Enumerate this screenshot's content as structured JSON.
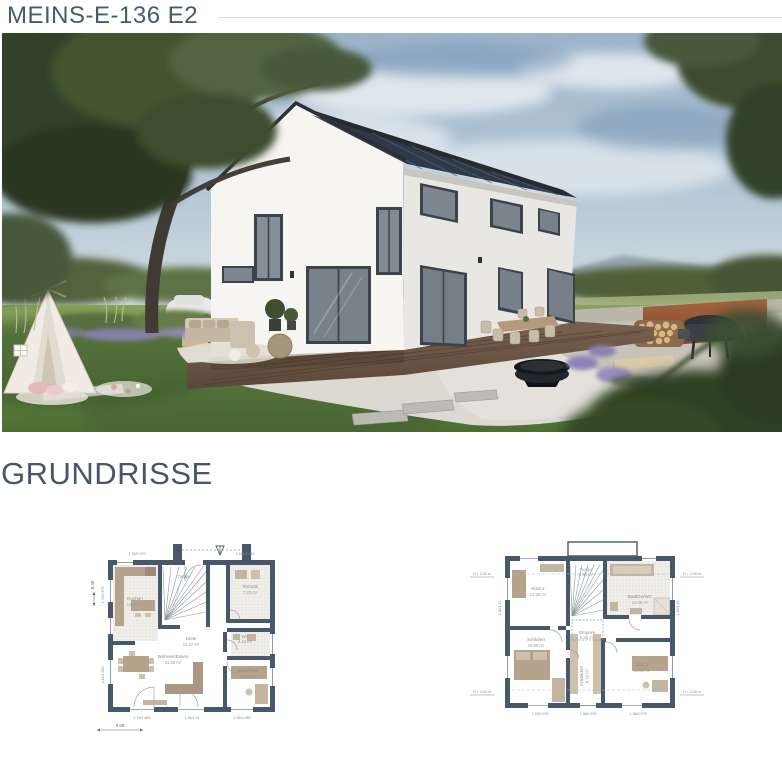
{
  "header": {
    "title": "MEINS-E-136 E2"
  },
  "section": {
    "heading": "GRUNDRISSE"
  },
  "colors": {
    "accent_text": "#46566b",
    "divider": "#dadada",
    "plan_wall": "#47586b",
    "plan_furniture": "#b7a28c",
    "corten_wall": "#9c5a34",
    "roof": "#262b31"
  },
  "floorplans": {
    "erdgeschoss": {
      "rooms": {
        "kochen": {
          "label": "Kochen",
          "area": "12.05 m²"
        },
        "treppe": {
          "label": "Treppe",
          "area": "5.98 m²"
        },
        "technik": {
          "label": "Technik",
          "area": "7.23 m²"
        },
        "diele": {
          "label": "Diele",
          "area": "12.27 m²"
        },
        "wc": {
          "label": "WC",
          "area": "3.34 m²"
        },
        "wohnen": {
          "label": "Wohnen/Essen",
          "area": "31.06 m²"
        },
        "buero": {
          "label": "Büro/Gast",
          "area": "10.35 m²"
        }
      },
      "dimensions": {
        "width": "9.58",
        "height": "8.48",
        "top_left": "1.76/0.975",
        "top_right": "1.185/2.415",
        "bottom_left": "1.76/1.885",
        "bottom_mid": "1.36/1.01",
        "bottom_right": "1.36/1.085",
        "left_top": "1.76/0.975",
        "left_bottom": "2.26/1.885"
      }
    },
    "obergeschoss": {
      "rooms": {
        "kind2": {
          "label": "Kind 2",
          "area": "13.25 m²"
        },
        "treppe": {
          "label": "Treppe",
          "area": "5.98 m²"
        },
        "bad": {
          "label": "Bad/Du/WC",
          "area": "12.06 m²"
        },
        "empore": {
          "label": "Empore",
          "area": "5.36 m²"
        },
        "schlafen": {
          "label": "Schlafen",
          "area": "16.99 m²"
        },
        "ankleiden": {
          "label": "Ankleiden",
          "area": "8.33 m²"
        },
        "kind1": {
          "label": "Kind 1",
          "area": "13.80 m²"
        }
      },
      "dimensions": {
        "kniestock": "H = 2.00 m",
        "bottom_left": "1.76/0.975",
        "bottom_mid": "1.36/0.975",
        "bottom_right": "1.38/0.975",
        "side_left": "1.36/1.43",
        "side_right": "1.36/1.43"
      }
    }
  }
}
